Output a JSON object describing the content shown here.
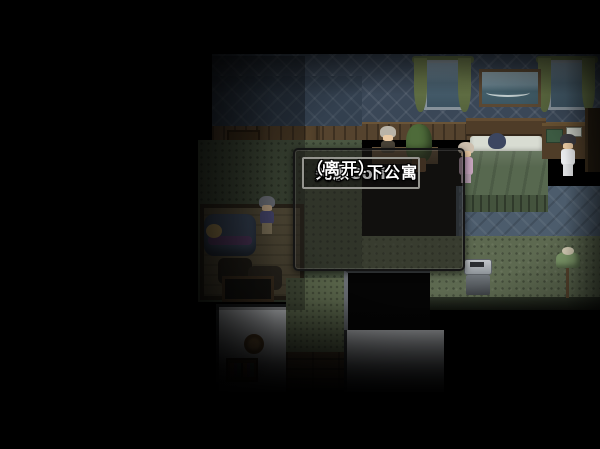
{
  "dialog": {
    "options": [
      {
        "label": "关于Colin",
        "selected": false
      },
      {
        "label": "光顾一下公寓",
        "selected": true
      },
      {
        "label": "（离开）",
        "selected": false
      }
    ]
  },
  "colors": {
    "background": "#000000",
    "dialog_bg": "rgba(30,28,24,0.58)",
    "dialog_border": "#141414",
    "selection_border": "#95958f",
    "text": "#ffffff",
    "wallpaper_blue": "#3a4757",
    "hall_floor_green": "#5d6950",
    "left_floor_green": "#4b5742",
    "carpet_blue": "#4c5c6c",
    "curtain_green": "#66744a",
    "blanket_green": "#57684f",
    "wood_brown": "#55432e",
    "lower_wall_gray": "#c6c9cd"
  }
}
